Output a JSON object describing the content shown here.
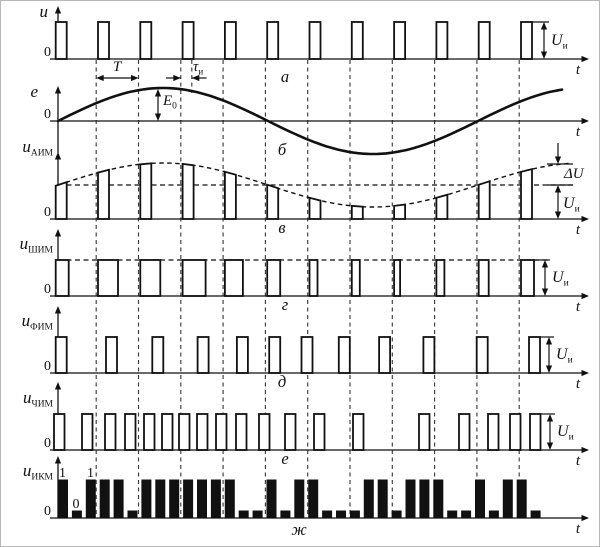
{
  "figure": {
    "background": "#ffffff",
    "ink": "#111111",
    "grid_color": "#3c3c3c",
    "description": "Types of pulse modulation waveforms"
  },
  "panels": [
    {
      "key": "carrier-pulses",
      "letter": "а",
      "axis_var": "u",
      "axis_sub": "",
      "zero": "0",
      "time_var": "t",
      "annotations": {
        "period": "T",
        "pulse_width_base": "τ",
        "pulse_width_sub": "и",
        "amplitude_base": "U",
        "amplitude_sub": "и"
      }
    },
    {
      "key": "modulating-signal",
      "letter": "б",
      "axis_var": "e",
      "axis_sub": "",
      "zero": "0",
      "time_var": "t",
      "annotations": {
        "amplitude_base": "E",
        "amplitude_sub": "0"
      }
    },
    {
      "key": "aim-pam",
      "letter": "в",
      "axis_var": "u",
      "axis_sub": "АИМ",
      "zero": "0",
      "time_var": "t",
      "annotations": {
        "delta": "ΔU",
        "amplitude_base": "U",
        "amplitude_sub": "и"
      }
    },
    {
      "key": "shim-pwm",
      "letter": "г",
      "axis_var": "u",
      "axis_sub": "ШИМ",
      "zero": "0",
      "time_var": "t",
      "annotations": {
        "amplitude_base": "U",
        "amplitude_sub": "и"
      }
    },
    {
      "key": "fim-ppm",
      "letter": "д",
      "axis_var": "u",
      "axis_sub": "ФИМ",
      "zero": "0",
      "time_var": "t",
      "annotations": {
        "amplitude_base": "U",
        "amplitude_sub": "и"
      }
    },
    {
      "key": "chim-pfm",
      "letter": "е",
      "axis_var": "u",
      "axis_sub": "ЧИМ",
      "zero": "0",
      "time_var": "t",
      "annotations": {
        "amplitude_base": "U",
        "amplitude_sub": "и"
      }
    },
    {
      "key": "ikm-pcm",
      "letter": "ж",
      "axis_var": "u",
      "axis_sub": "ИКМ",
      "zero": "0",
      "time_var": "t",
      "bit_labels": [
        "1",
        "0",
        "1"
      ]
    }
  ],
  "waveform_data": {
    "pulse_count": 12,
    "grid_count": 11,
    "pwm_widths": [
      13,
      20,
      20,
      23,
      18,
      13,
      8,
      8,
      6,
      8,
      10,
      13
    ],
    "ppm_shifts": [
      0,
      8,
      12,
      15,
      12,
      2,
      -8,
      -13,
      -15,
      -13,
      -2,
      8
    ],
    "pfm_pulse_x": [
      53,
      81,
      104,
      124,
      143,
      161,
      178,
      196,
      215,
      235,
      258,
      284,
      313,
      352,
      418,
      458,
      487,
      509,
      529
    ],
    "pcm_bits": [
      1,
      0,
      1,
      1,
      1,
      0,
      1,
      1,
      1,
      1,
      1,
      1,
      1,
      0,
      0,
      1,
      0,
      1,
      1,
      0,
      0,
      0,
      1,
      1,
      0,
      1,
      1,
      1,
      0,
      0,
      1,
      0,
      1,
      1,
      0
    ]
  }
}
